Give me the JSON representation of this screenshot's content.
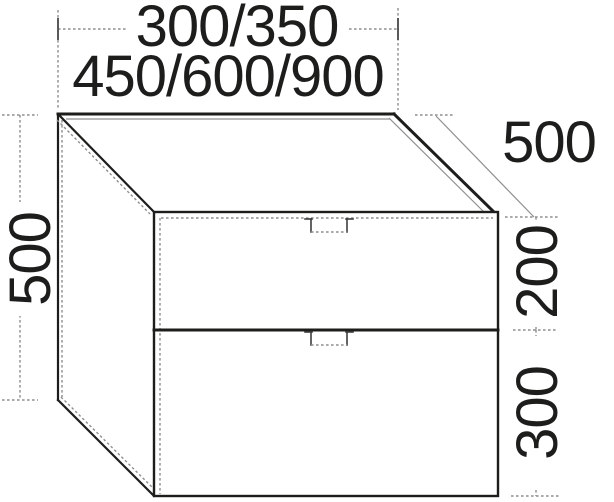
{
  "diagram": {
    "dimension_labels": {
      "width_row1": "300/350",
      "width_row2": "450/600/900",
      "height": "500",
      "depth": "500",
      "upper_drawer_height": "200",
      "lower_drawer_height": "300"
    },
    "colors": {
      "outline": "#1d1d1b",
      "dimension_line": "#8f8f8f",
      "background": "#ffffff"
    }
  }
}
